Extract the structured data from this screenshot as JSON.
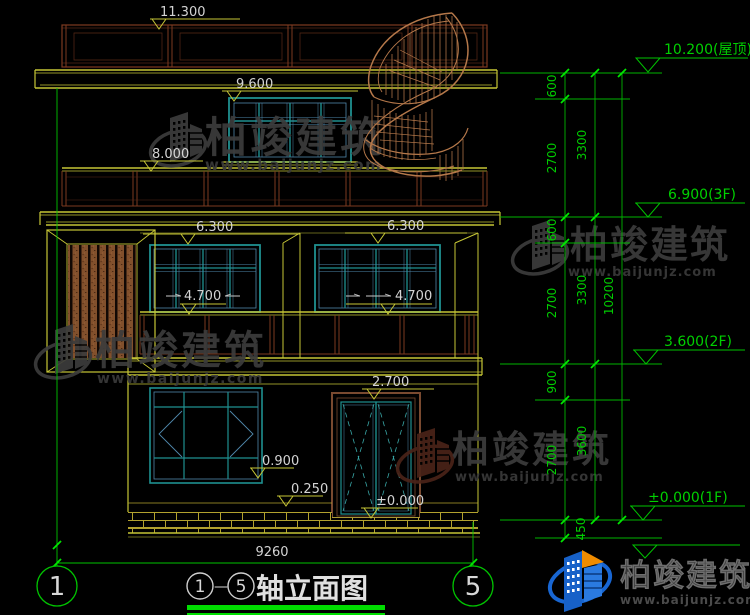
{
  "colors": {
    "background": "#000000",
    "cad_yellow": "#c6c636",
    "cad_green": "#00c400",
    "bright_green": "#00e800",
    "teal_window": "#1f9090",
    "light_blue": "#4f88ab",
    "railing_brown": "#7d3a20",
    "wood_brown": "#82502c",
    "stair_tan": "#b5784a",
    "text_white": "#d4d4d4",
    "watermark_gray": "#3c3c3c",
    "logo_blue": "#1761c8",
    "logo_orange": "#f08c00"
  },
  "markers": {
    "m11300": "11.300",
    "m9600": "9.600",
    "m8000": "8.000",
    "m6300a": "6.300",
    "m6300b": "6.300",
    "m4700a": "4.700",
    "m4700b": "4.700",
    "m2700": "2.700",
    "m0900": "0.900",
    "m0250": "0.250",
    "m0000": "±0.000"
  },
  "levels": {
    "roof": "10.200(屋顶)",
    "f3": "6.900(3F)",
    "f2": "3.600(2F)",
    "f1": "±0.000(1F)"
  },
  "chain": {
    "col1": [
      "600",
      "2700",
      "600",
      "2700",
      "900",
      "2700",
      "450"
    ],
    "col2": [
      "3300",
      "3300",
      "3600"
    ],
    "col3": [
      "10200"
    ]
  },
  "footer": {
    "overall_width": "9260",
    "axis_left": "1",
    "axis_right": "5",
    "title_start": "1",
    "title_dash": "—",
    "title_end": "5",
    "title_label": "轴立面图"
  },
  "watermark": {
    "brand": "柏竣建筑",
    "url": "www.baijunjz.com"
  },
  "brand": {
    "name": "柏竣建筑",
    "url": "www.baijunjz.com"
  }
}
